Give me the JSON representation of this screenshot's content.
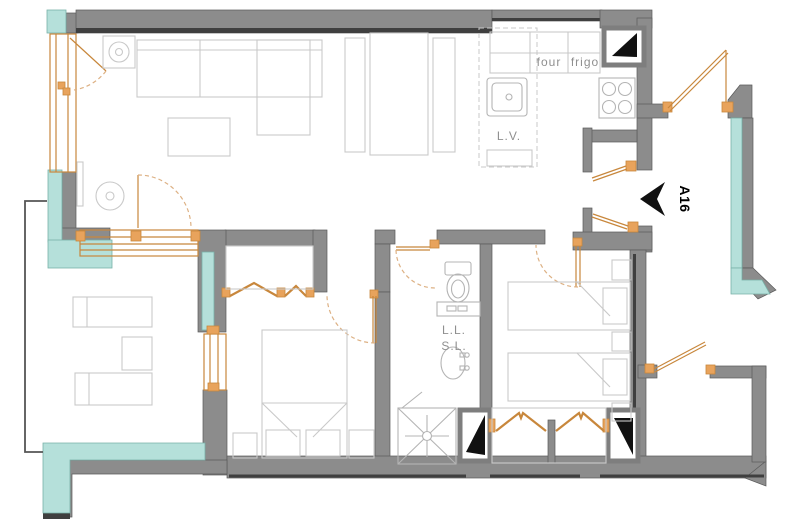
{
  "plan": {
    "apartment_label": "A16",
    "kitchen_labels": {
      "oven": "four",
      "fridge": "frigo",
      "dishwasher": "L.V."
    },
    "bathroom_labels": {
      "washing_machine": "L.L.",
      "dryer": "S.L."
    }
  },
  "colors": {
    "wall": "#8c8c8c",
    "wall_dark": "#3f3f3f",
    "wall_line": "#5a5a5a",
    "glazing": "#b5e0da",
    "glazing_border": "#79b1a8",
    "joinery": "#c8873c",
    "joinery_fill": "#e8a35c",
    "swing": "#ddb184",
    "furniture": "#c9c9c9",
    "label": "#8f8f8f",
    "arrow": "#0a0a0a"
  }
}
